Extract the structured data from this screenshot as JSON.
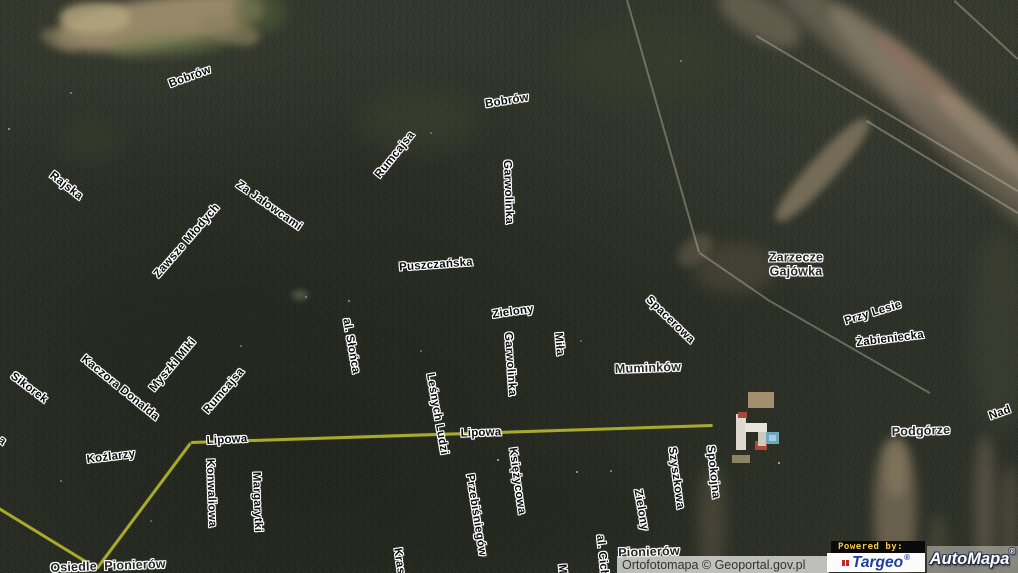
{
  "map": {
    "street_labels": [
      {
        "t": "Bobrów",
        "x": 190,
        "y": 77,
        "r": -20
      },
      {
        "t": "Rajska",
        "x": 66,
        "y": 186,
        "r": 38
      },
      {
        "t": "Za Jałowcami",
        "x": 269,
        "y": 206,
        "r": 35
      },
      {
        "t": "Zawsze Młodych",
        "x": 187,
        "y": 241,
        "r": -49
      },
      {
        "t": "Bobrów",
        "x": 507,
        "y": 101,
        "r": -9
      },
      {
        "t": "Rumcajsa",
        "x": 395,
        "y": 155,
        "r": -51
      },
      {
        "t": "Garwolinka",
        "x": 508,
        "y": 192,
        "r": 88
      },
      {
        "t": "Puszczańska",
        "x": 436,
        "y": 265,
        "r": -4
      },
      {
        "t": "Zielony",
        "x": 513,
        "y": 312,
        "r": -8
      },
      {
        "t": "Spacerowa",
        "x": 670,
        "y": 320,
        "r": 44
      },
      {
        "t": "Przy Lesie",
        "x": 873,
        "y": 313,
        "r": -17
      },
      {
        "t": "Żabieniecka",
        "x": 890,
        "y": 339,
        "r": -7
      },
      {
        "t": "al. Słońca",
        "x": 351,
        "y": 346,
        "r": 80
      },
      {
        "t": "Garwolinka",
        "x": 510,
        "y": 364,
        "r": 86
      },
      {
        "t": "Miła",
        "x": 559,
        "y": 344,
        "r": 85
      },
      {
        "t": "Sikorek",
        "x": 29,
        "y": 388,
        "r": 37
      },
      {
        "t": "Kaczora Donalda",
        "x": 120,
        "y": 388,
        "r": 39
      },
      {
        "t": "Myszki Miki",
        "x": 173,
        "y": 365,
        "r": -50
      },
      {
        "t": "Rumcajsa",
        "x": 224,
        "y": 391,
        "r": -49
      },
      {
        "t": "Nad",
        "x": 1000,
        "y": 413,
        "r": -20
      },
      {
        "t": "Lipowa",
        "x": 227,
        "y": 440,
        "r": -3
      },
      {
        "t": "Lipowa",
        "x": 481,
        "y": 433,
        "r": -2
      },
      {
        "t": "Koźlarzy",
        "x": 111,
        "y": 457,
        "r": -7
      },
      {
        "t": "Konwaliowa",
        "x": 211,
        "y": 493,
        "r": 88
      },
      {
        "t": "Margarytki",
        "x": 257,
        "y": 502,
        "r": 88
      },
      {
        "t": "Leśnych Ludzi",
        "x": 437,
        "y": 414,
        "r": 80
      },
      {
        "t": "Księżycowa",
        "x": 517,
        "y": 481,
        "r": 82
      },
      {
        "t": "Przebiśniegów",
        "x": 476,
        "y": 515,
        "r": 81
      },
      {
        "t": "Szyszkowa",
        "x": 676,
        "y": 478,
        "r": 82
      },
      {
        "t": "Zielony",
        "x": 641,
        "y": 510,
        "r": 80
      },
      {
        "t": "Spokojna",
        "x": 713,
        "y": 472,
        "r": 84
      },
      {
        "t": "Kras",
        "x": 399,
        "y": 561,
        "r": 82
      },
      {
        "t": "M",
        "x": 562,
        "y": 569,
        "r": 85
      },
      {
        "t": "al. Cich",
        "x": 602,
        "y": 556,
        "r": 84
      },
      {
        "t": "a",
        "x": 2,
        "y": 441,
        "r": 40
      }
    ],
    "place_labels": [
      {
        "t": "Zarzecze\nGajówka",
        "x": 796,
        "y": 265,
        "r": 0
      },
      {
        "t": "Muminków",
        "x": 648,
        "y": 368,
        "r": -2
      },
      {
        "t": "Podgórze",
        "x": 921,
        "y": 431,
        "r": -2
      },
      {
        "t": "Pionierów",
        "x": 649,
        "y": 552,
        "r": -2
      },
      {
        "t": "Osiedle  Pionierów",
        "x": 108,
        "y": 566,
        "r": -2
      }
    ],
    "roads": {
      "color": "#a8a92f",
      "segments": [
        [
          -6,
          504,
          97,
          567
        ],
        [
          97,
          567,
          191,
          441
        ],
        [
          191,
          441,
          713,
          424
        ]
      ]
    },
    "trails": [
      [
        628,
        0,
        700,
        252
      ],
      [
        700,
        252,
        770,
        300
      ],
      [
        770,
        300,
        930,
        392
      ],
      [
        867,
        120,
        1018,
        212
      ],
      [
        757,
        35,
        1018,
        190
      ],
      [
        955,
        0,
        1018,
        58
      ]
    ],
    "terrain_patches": [
      [
        160,
        22,
        210,
        48,
        -8,
        "#a79673",
        0.85,
        5
      ],
      [
        95,
        18,
        70,
        30,
        0,
        "#b5a77f",
        0.8,
        4
      ],
      [
        230,
        30,
        60,
        26,
        15,
        "#8d8060",
        0.7,
        4
      ],
      [
        170,
        45,
        120,
        22,
        -5,
        "#6f7a4c",
        0.5,
        5
      ],
      [
        260,
        12,
        50,
        40,
        0,
        "#4e5c38",
        0.6,
        6
      ],
      [
        60,
        40,
        40,
        18,
        20,
        "#8a7d5f",
        0.6,
        4
      ],
      [
        860,
        50,
        300,
        38,
        42,
        "#6f6857",
        0.75,
        6
      ],
      [
        950,
        115,
        320,
        44,
        42,
        "#857b68",
        0.8,
        6
      ],
      [
        1000,
        185,
        260,
        34,
        42,
        "#6b6252",
        0.7,
        6
      ],
      [
        920,
        75,
        120,
        20,
        42,
        "#93705f",
        0.6,
        4
      ],
      [
        990,
        140,
        140,
        22,
        42,
        "#9c8a74",
        0.6,
        4
      ],
      [
        760,
        18,
        90,
        40,
        30,
        "#7d7360",
        0.6,
        6
      ],
      [
        822,
        170,
        135,
        26,
        -48,
        "#80755f",
        0.85,
        4
      ],
      [
        735,
        268,
        80,
        50,
        0,
        "#58513f",
        0.5,
        8
      ],
      [
        1000,
        330,
        60,
        200,
        0,
        "#4a4a3c",
        0.4,
        10
      ],
      [
        895,
        510,
        42,
        140,
        0,
        "#7d7059",
        0.75,
        6
      ],
      [
        896,
        468,
        24,
        60,
        0,
        "#8a7d64",
        0.6,
        5
      ],
      [
        985,
        505,
        22,
        140,
        0,
        "#6d6150",
        0.6,
        6
      ],
      [
        1010,
        520,
        18,
        110,
        0,
        "#5e5546",
        0.6,
        6
      ],
      [
        938,
        545,
        20,
        60,
        0,
        "#56503f",
        0.5,
        6
      ],
      [
        712,
        520,
        26,
        110,
        0,
        "#655b47",
        0.5,
        8
      ],
      [
        420,
        120,
        120,
        60,
        0,
        "#3e4433",
        0.5,
        12
      ],
      [
        640,
        60,
        160,
        80,
        0,
        "#39402f",
        0.5,
        14
      ],
      [
        180,
        330,
        200,
        120,
        0,
        "#242820",
        0.5,
        16
      ],
      [
        520,
        520,
        300,
        80,
        0,
        "#23261e",
        0.4,
        16
      ],
      [
        90,
        140,
        60,
        40,
        0,
        "#3a4030",
        0.5,
        10
      ],
      [
        300,
        295,
        16,
        10,
        0,
        "#7a7a60",
        0.5,
        3
      ],
      [
        695,
        250,
        40,
        24,
        -40,
        "#6e6450",
        0.5,
        4
      ]
    ],
    "features": [
      [
        748,
        392,
        26,
        16,
        "#a38f6b"
      ],
      [
        736,
        414,
        10,
        36,
        "#ddd8d0"
      ],
      [
        745,
        423,
        22,
        9,
        "#e8e4da"
      ],
      [
        738,
        412,
        9,
        6,
        "#a34a38"
      ],
      [
        755,
        441,
        12,
        9,
        "#b0493a"
      ],
      [
        758,
        432,
        8,
        14,
        "#cfc9bd"
      ],
      [
        766,
        432,
        13,
        12,
        "#6fa8bd"
      ],
      [
        769,
        435,
        7,
        6,
        "#9fd0dd"
      ],
      [
        732,
        455,
        18,
        8,
        "#8c8266"
      ]
    ],
    "speckles": [
      [
        8,
        128,
        2,
        0.7
      ],
      [
        70,
        92,
        2,
        0.5
      ],
      [
        348,
        300,
        2,
        0.6
      ],
      [
        305,
        296,
        2,
        0.5
      ],
      [
        430,
        132,
        2,
        0.4
      ],
      [
        497,
        459,
        2,
        0.8
      ],
      [
        576,
        471,
        2,
        0.7
      ],
      [
        778,
        462,
        2,
        0.8
      ],
      [
        420,
        350,
        1.5,
        0.4
      ],
      [
        240,
        345,
        1.5,
        0.4
      ],
      [
        610,
        470,
        1.5,
        0.5
      ],
      [
        60,
        480,
        1.5,
        0.4
      ],
      [
        680,
        60,
        1.5,
        0.4
      ],
      [
        580,
        340,
        1.5,
        0.35
      ],
      [
        150,
        520,
        1.5,
        0.35
      ]
    ]
  },
  "footer": {
    "attribution": "Ortofotomapa © Geoportal.gov.pl",
    "powered_by": "Powered by:",
    "targeo": {
      "name": "Targeo",
      "reg": "®"
    },
    "automapa": {
      "name": "AutoMapa",
      "reg": "®"
    }
  }
}
